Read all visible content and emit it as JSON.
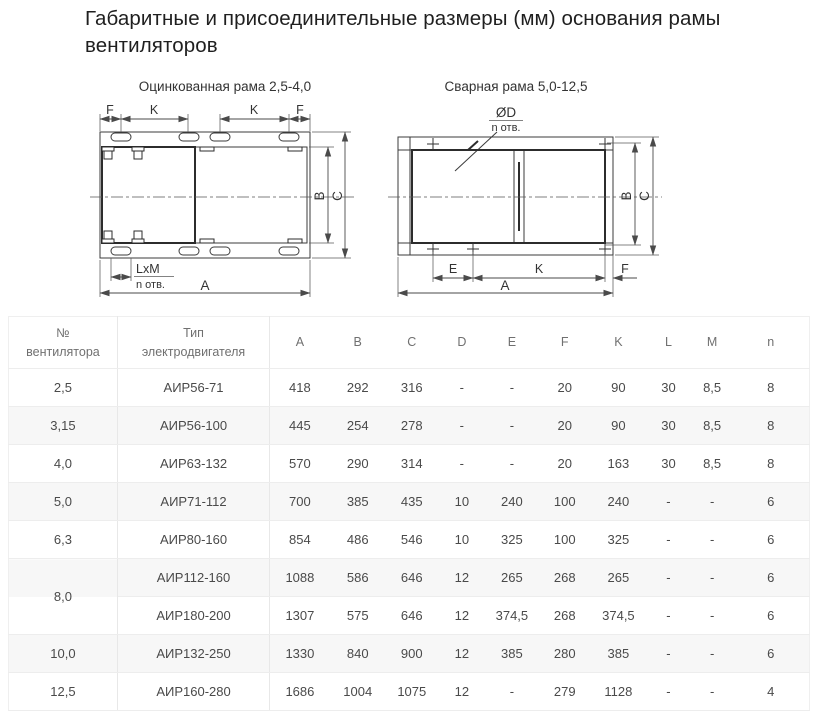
{
  "page_title": "Габаритные и присоединительные размеры (мм) основания рамы вентиляторов",
  "drawings": {
    "left": {
      "title": "Оцинкованная рама 2,5-4,0",
      "labels": {
        "f": "F",
        "k": "K",
        "a": "A",
        "b": "B",
        "c": "C",
        "lxm": "LxM",
        "n_holes": "n отв."
      }
    },
    "right": {
      "title": "Сварная рама 5,0-12,5",
      "labels": {
        "d": "ØD",
        "n_holes": "n отв.",
        "e": "E",
        "k": "K",
        "f": "F",
        "a": "A",
        "b": "B",
        "c": "C"
      }
    }
  },
  "table": {
    "columns": [
      "№\nвентилятора",
      "Тип\nэлектродвигателя",
      "A",
      "B",
      "C",
      "D",
      "E",
      "F",
      "K",
      "L",
      "M",
      "n"
    ],
    "groups": [
      {
        "num": "2,5",
        "rows": [
          [
            "АИР56-71",
            "418",
            "292",
            "316",
            "-",
            "-",
            "20",
            "90",
            "30",
            "8,5",
            "8"
          ]
        ]
      },
      {
        "num": "3,15",
        "rows": [
          [
            "АИР56-100",
            "445",
            "254",
            "278",
            "-",
            "-",
            "20",
            "90",
            "30",
            "8,5",
            "8"
          ]
        ]
      },
      {
        "num": "4,0",
        "rows": [
          [
            "АИР63-132",
            "570",
            "290",
            "314",
            "-",
            "-",
            "20",
            "163",
            "30",
            "8,5",
            "8"
          ]
        ]
      },
      {
        "num": "5,0",
        "rows": [
          [
            "АИР71-112",
            "700",
            "385",
            "435",
            "10",
            "240",
            "100",
            "240",
            "-",
            "-",
            "6"
          ]
        ]
      },
      {
        "num": "6,3",
        "rows": [
          [
            "АИР80-160",
            "854",
            "486",
            "546",
            "10",
            "325",
            "100",
            "325",
            "-",
            "-",
            "6"
          ]
        ]
      },
      {
        "num": "8,0",
        "rows": [
          [
            "АИР112-160",
            "1088",
            "586",
            "646",
            "12",
            "265",
            "268",
            "265",
            "-",
            "-",
            "6"
          ],
          [
            "АИР180-200",
            "1307",
            "575",
            "646",
            "12",
            "374,5",
            "268",
            "374,5",
            "-",
            "-",
            "6"
          ]
        ]
      },
      {
        "num": "10,0",
        "rows": [
          [
            "АИР132-250",
            "1330",
            "840",
            "900",
            "12",
            "385",
            "280",
            "385",
            "-",
            "-",
            "6"
          ]
        ]
      },
      {
        "num": "12,5",
        "rows": [
          [
            "АИР160-280",
            "1686",
            "1004",
            "1075",
            "12",
            "-",
            "279",
            "1128",
            "-",
            "-",
            "4"
          ]
        ]
      }
    ]
  }
}
